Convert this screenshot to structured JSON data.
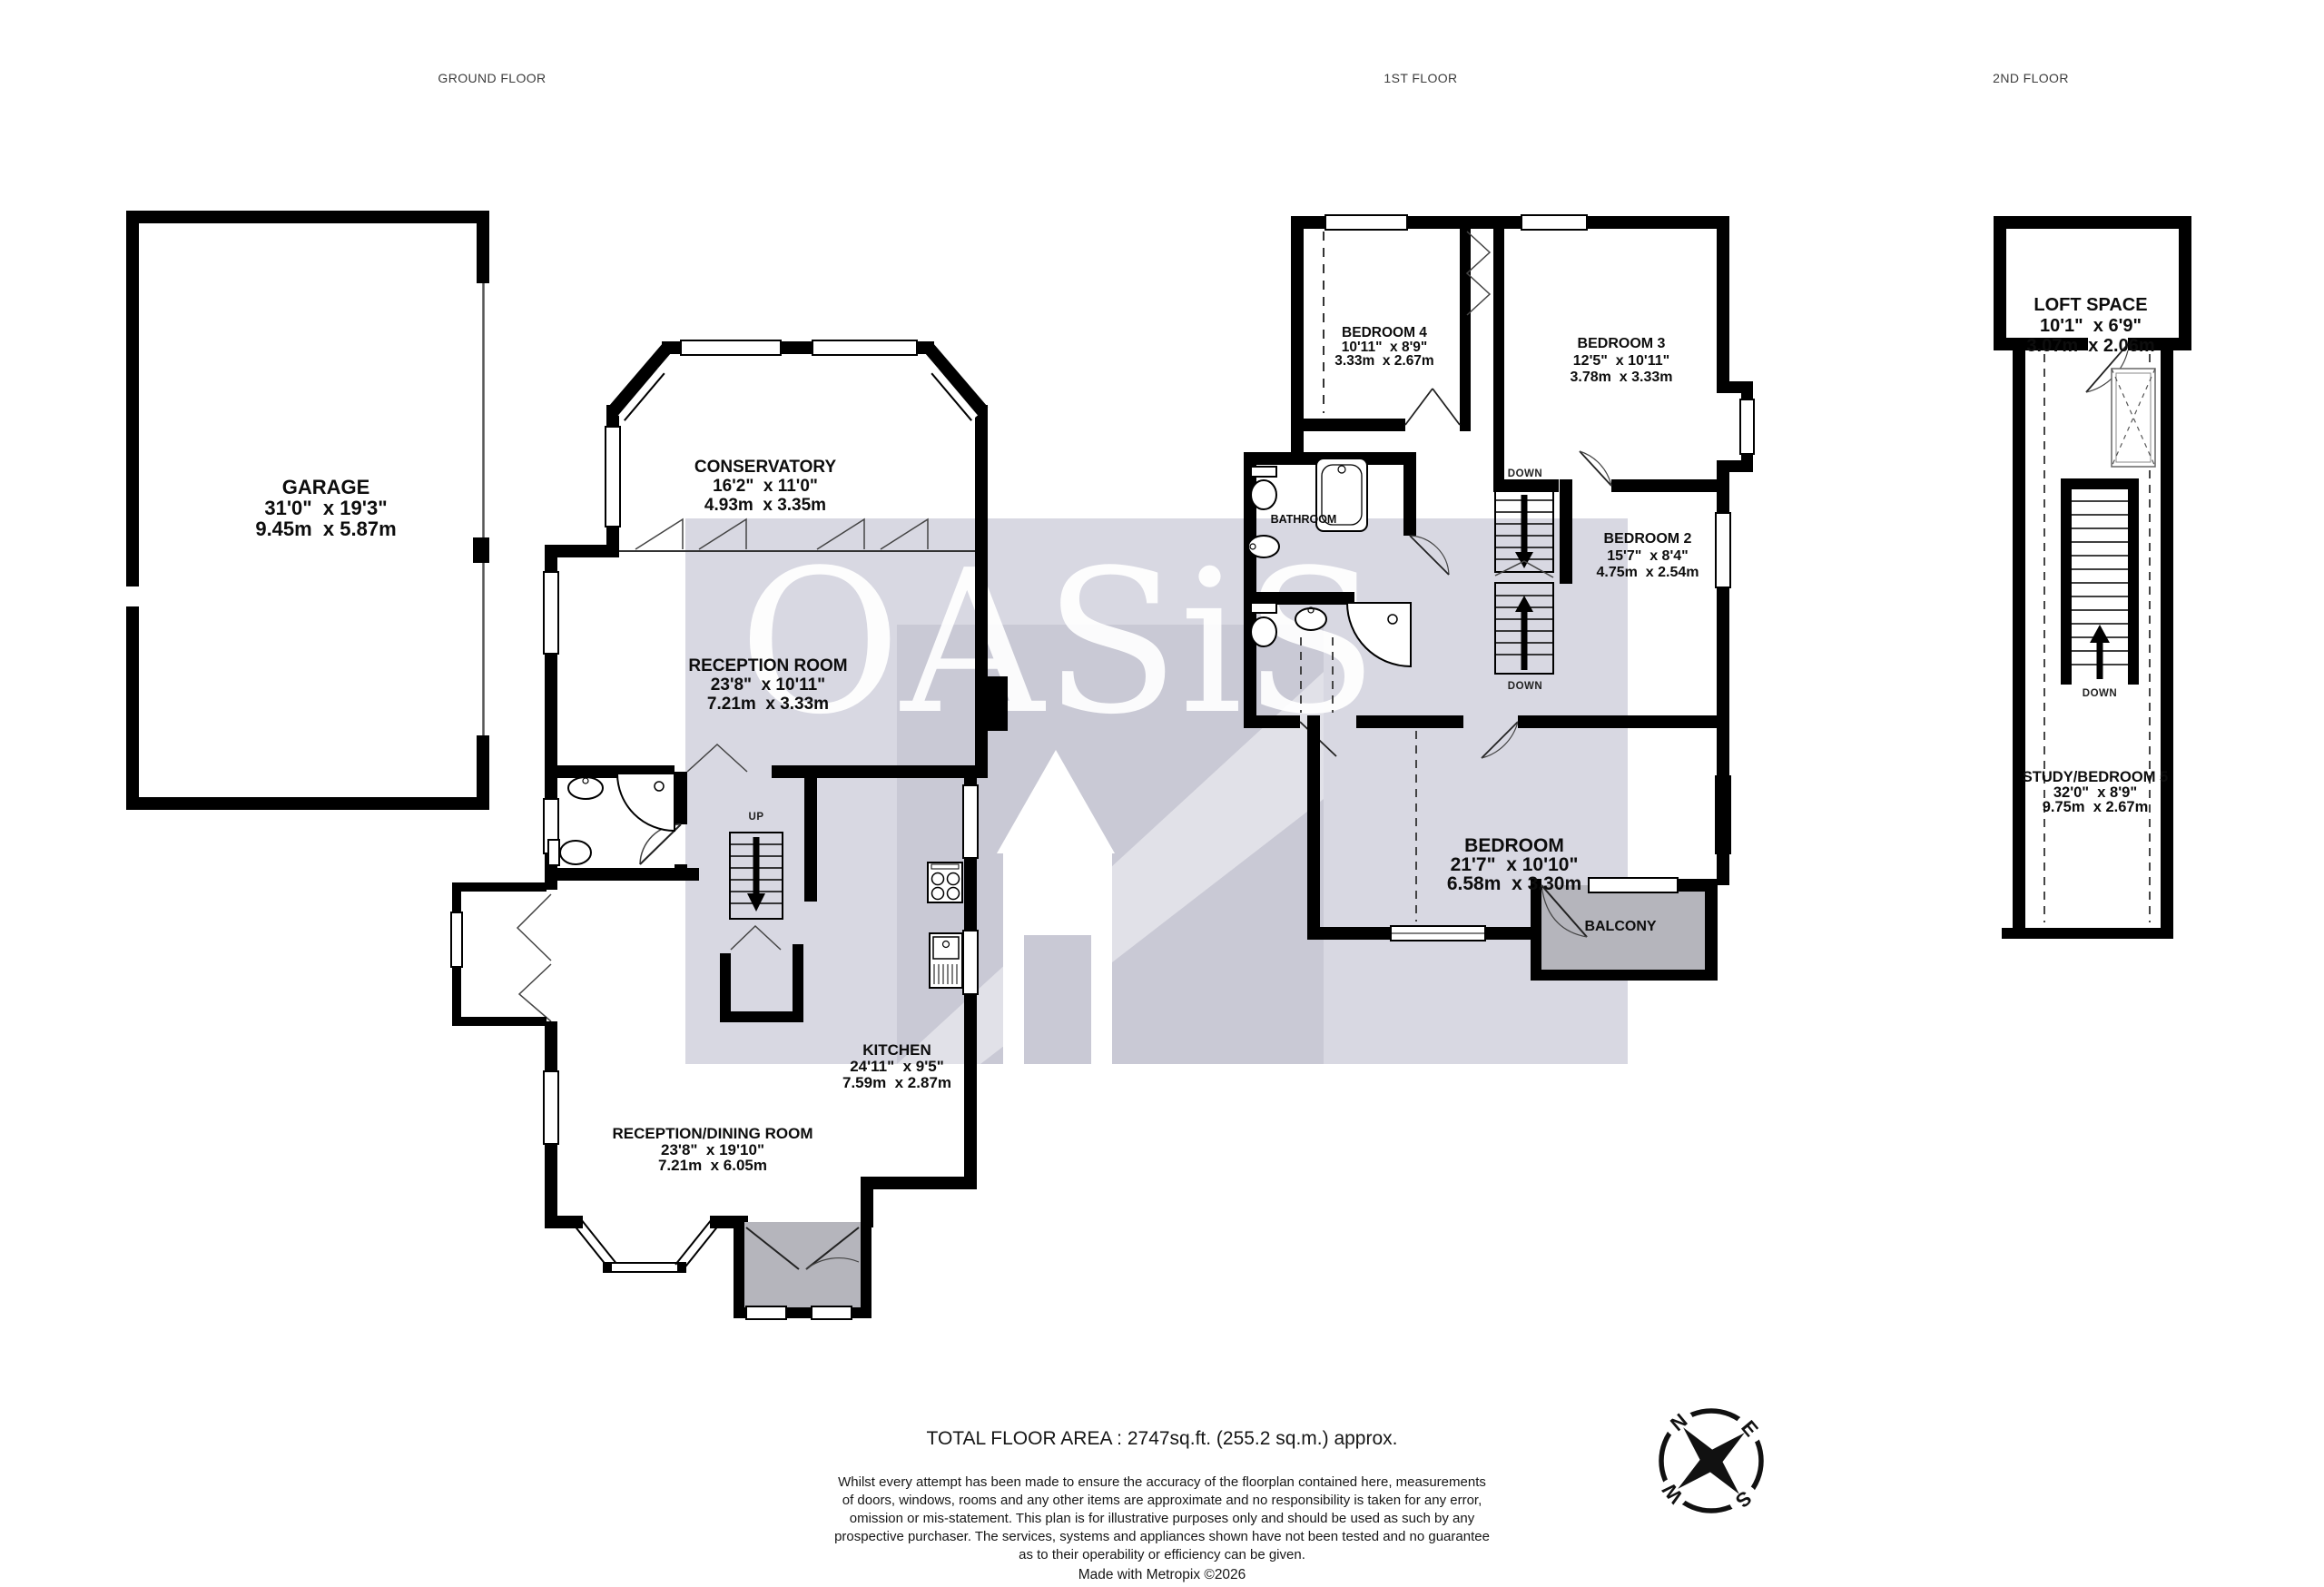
{
  "titles": {
    "ground": "GROUND FLOOR",
    "first": "1ST FLOOR",
    "second": "2ND FLOOR"
  },
  "watermark": {
    "text": "OASiS"
  },
  "rooms": {
    "garage": {
      "name": "GARAGE",
      "imperial": "31'0\"  x 19'3\"",
      "metric": "9.45m  x 5.87m"
    },
    "conservatory": {
      "name": "CONSERVATORY",
      "imperial": "16'2\"  x 11'0\"",
      "metric": "4.93m  x 3.35m"
    },
    "reception": {
      "name": "RECEPTION ROOM",
      "imperial": "23'8\"  x 10'11\"",
      "metric": "7.21m  x 3.33m"
    },
    "kitchen": {
      "name": "KITCHEN",
      "imperial": "24'11\"  x 9'5\"",
      "metric": "7.59m  x 2.87m"
    },
    "reception_dining": {
      "name": "RECEPTION/DINING ROOM",
      "imperial": "23'8\"  x 19'10\"",
      "metric": "7.21m  x 6.05m"
    },
    "bedroom4": {
      "name": "BEDROOM 4",
      "imperial": "10'11\"  x 8'9\"",
      "metric": "3.33m  x 2.67m"
    },
    "bedroom3": {
      "name": "BEDROOM 3",
      "imperial": "12'5\"  x 10'11\"",
      "metric": "3.78m  x 3.33m"
    },
    "bedroom2": {
      "name": "BEDROOM 2",
      "imperial": "15'7\"  x 8'4\"",
      "metric": "4.75m  x 2.54m"
    },
    "bedroom_master": {
      "name": "BEDROOM",
      "imperial": "21'7\"  x 10'10\"",
      "metric": "6.58m  x 3.30m"
    },
    "loft": {
      "name": "LOFT SPACE",
      "imperial": "10'1\"  x 6'9\"",
      "metric": "3.07m  x 2.06m"
    },
    "study": {
      "name": "STUDY/BEDROOM 5",
      "imperial": "32'0\"  x 8'9\"",
      "metric": "9.75m  x 2.67m"
    }
  },
  "labels": {
    "up": "UP",
    "down": "DOWN",
    "bathroom": "BATHROOM",
    "balcony": "BALCONY"
  },
  "compass": {
    "n": "N",
    "e": "E",
    "s": "S",
    "w": "W"
  },
  "footer": {
    "total_area": "TOTAL FLOOR AREA : 2747sq.ft. (255.2 sq.m.) approx.",
    "disclaimer": [
      "Whilst every attempt has been made to ensure the accuracy of the floorplan contained here, measurements",
      "of doors, windows, rooms and any other items are approximate and no responsibility is taken for any error,",
      "omission or mis-statement. This plan is for illustrative purposes only and should be used as such by any",
      "prospective purchaser. The services, systems and appliances shown have not been tested and no guarantee",
      "as to their operability or efficiency can be given."
    ],
    "credit": "Made with Metropix ©2026"
  },
  "colors": {
    "wall": "#000000",
    "watermark_band": "#d8d8e2",
    "watermark_logo": "#c9c9d5",
    "porch_fill": "#b5b5bc"
  }
}
